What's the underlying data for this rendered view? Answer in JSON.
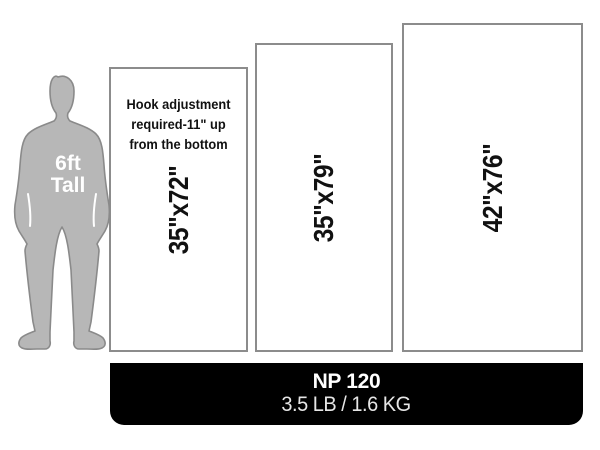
{
  "figure": {
    "label_line1": "6ft",
    "label_line2": "Tall"
  },
  "panels": [
    {
      "dimension": "35\"x72\"",
      "note_lines": [
        "Hook adjustment",
        "required-11\" up",
        "from the bottom"
      ]
    },
    {
      "dimension": "35\"x79\""
    },
    {
      "dimension": "42\"x76\""
    }
  ],
  "footer": {
    "model": "NP 120",
    "weight": "3.5 LB / 1.6 KG"
  },
  "colors": {
    "silhouette_fill": "#b7b7b7",
    "silhouette_outline": "#8a8a8a",
    "panel_border": "#8c8c8c",
    "panel_fill": "#ffffff",
    "footer_bg": "#000000",
    "label_text": "#111111",
    "footer_text": "#ffffff"
  }
}
